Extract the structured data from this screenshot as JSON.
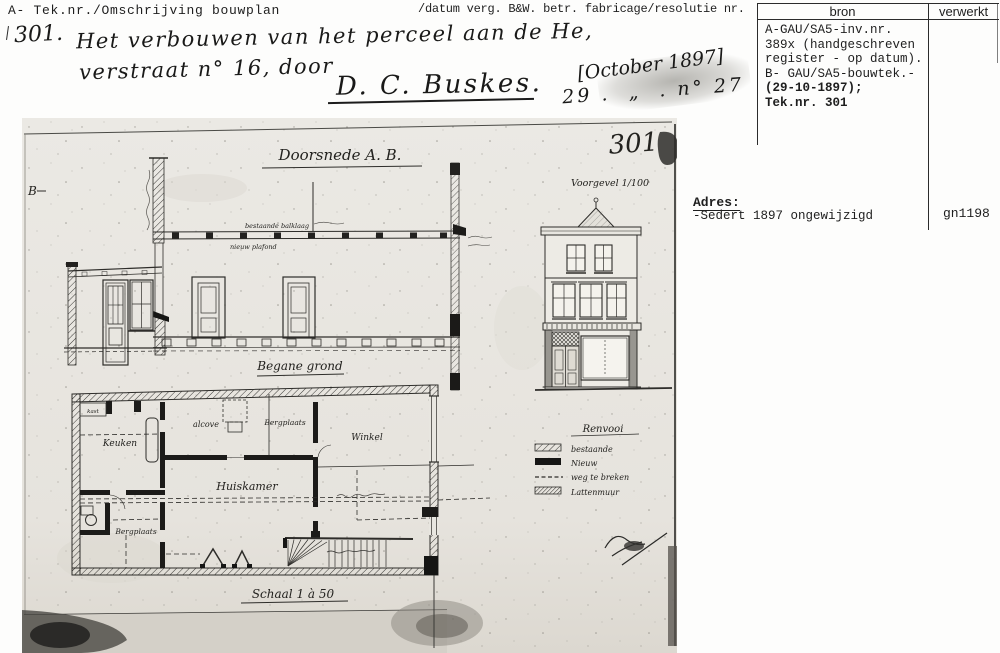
{
  "header": {
    "left_label": "A- Tek.nr./Omschrijving bouwplan",
    "right_label": "/datum verg. B&W. betr. fabricage/resolutie nr."
  },
  "ref_table": {
    "col1": "bron",
    "col2": "verwerkt",
    "bron_lines": [
      "A-GAU/SA5-inv.nr.",
      "389x (handgeschreven",
      "register - op datum).",
      "B- GAU/SA5-bouwtek.-",
      "(29-10-1897);",
      "Tek.nr. 301"
    ]
  },
  "adres": {
    "label": "Adres:",
    "value": "-Sedert 1897 ongewijzigd",
    "code": "gn1198"
  },
  "handwriting": {
    "number": "301.",
    "line1": "Het verbouwen van het perceel aan de He,",
    "line2": "verstraat n° 16, door",
    "signature": "D. C. Buskes.",
    "date_bracket": "[October 1897]",
    "date_line": "29 .  „  . n° 27"
  },
  "drawing": {
    "pencil_number": "301",
    "section_title": "Doorsnede A. B.",
    "section_label_b": "B",
    "beam_label_top": "bestaande balklaag",
    "beam_label_bottom": "nieuw plafond",
    "facade_title": "Voorgevel 1/100",
    "plan_title": "Begane grond",
    "scale_label": "Schaal 1 à 50",
    "rooms": {
      "kast": "kast",
      "keuken": "Keuken",
      "alcove": "alcove",
      "bergplaats_top": "Bergplaats",
      "winkel": "Winkel",
      "huiskamer": "Huiskamer",
      "bergplaats_bottom": "Bergplaats"
    },
    "legend": {
      "title": "Renvooi",
      "items": [
        {
          "label": "bestaande"
        },
        {
          "label": "Nieuw"
        },
        {
          "label": "weg te breken"
        },
        {
          "label": "Lattenmuur"
        }
      ]
    }
  }
}
